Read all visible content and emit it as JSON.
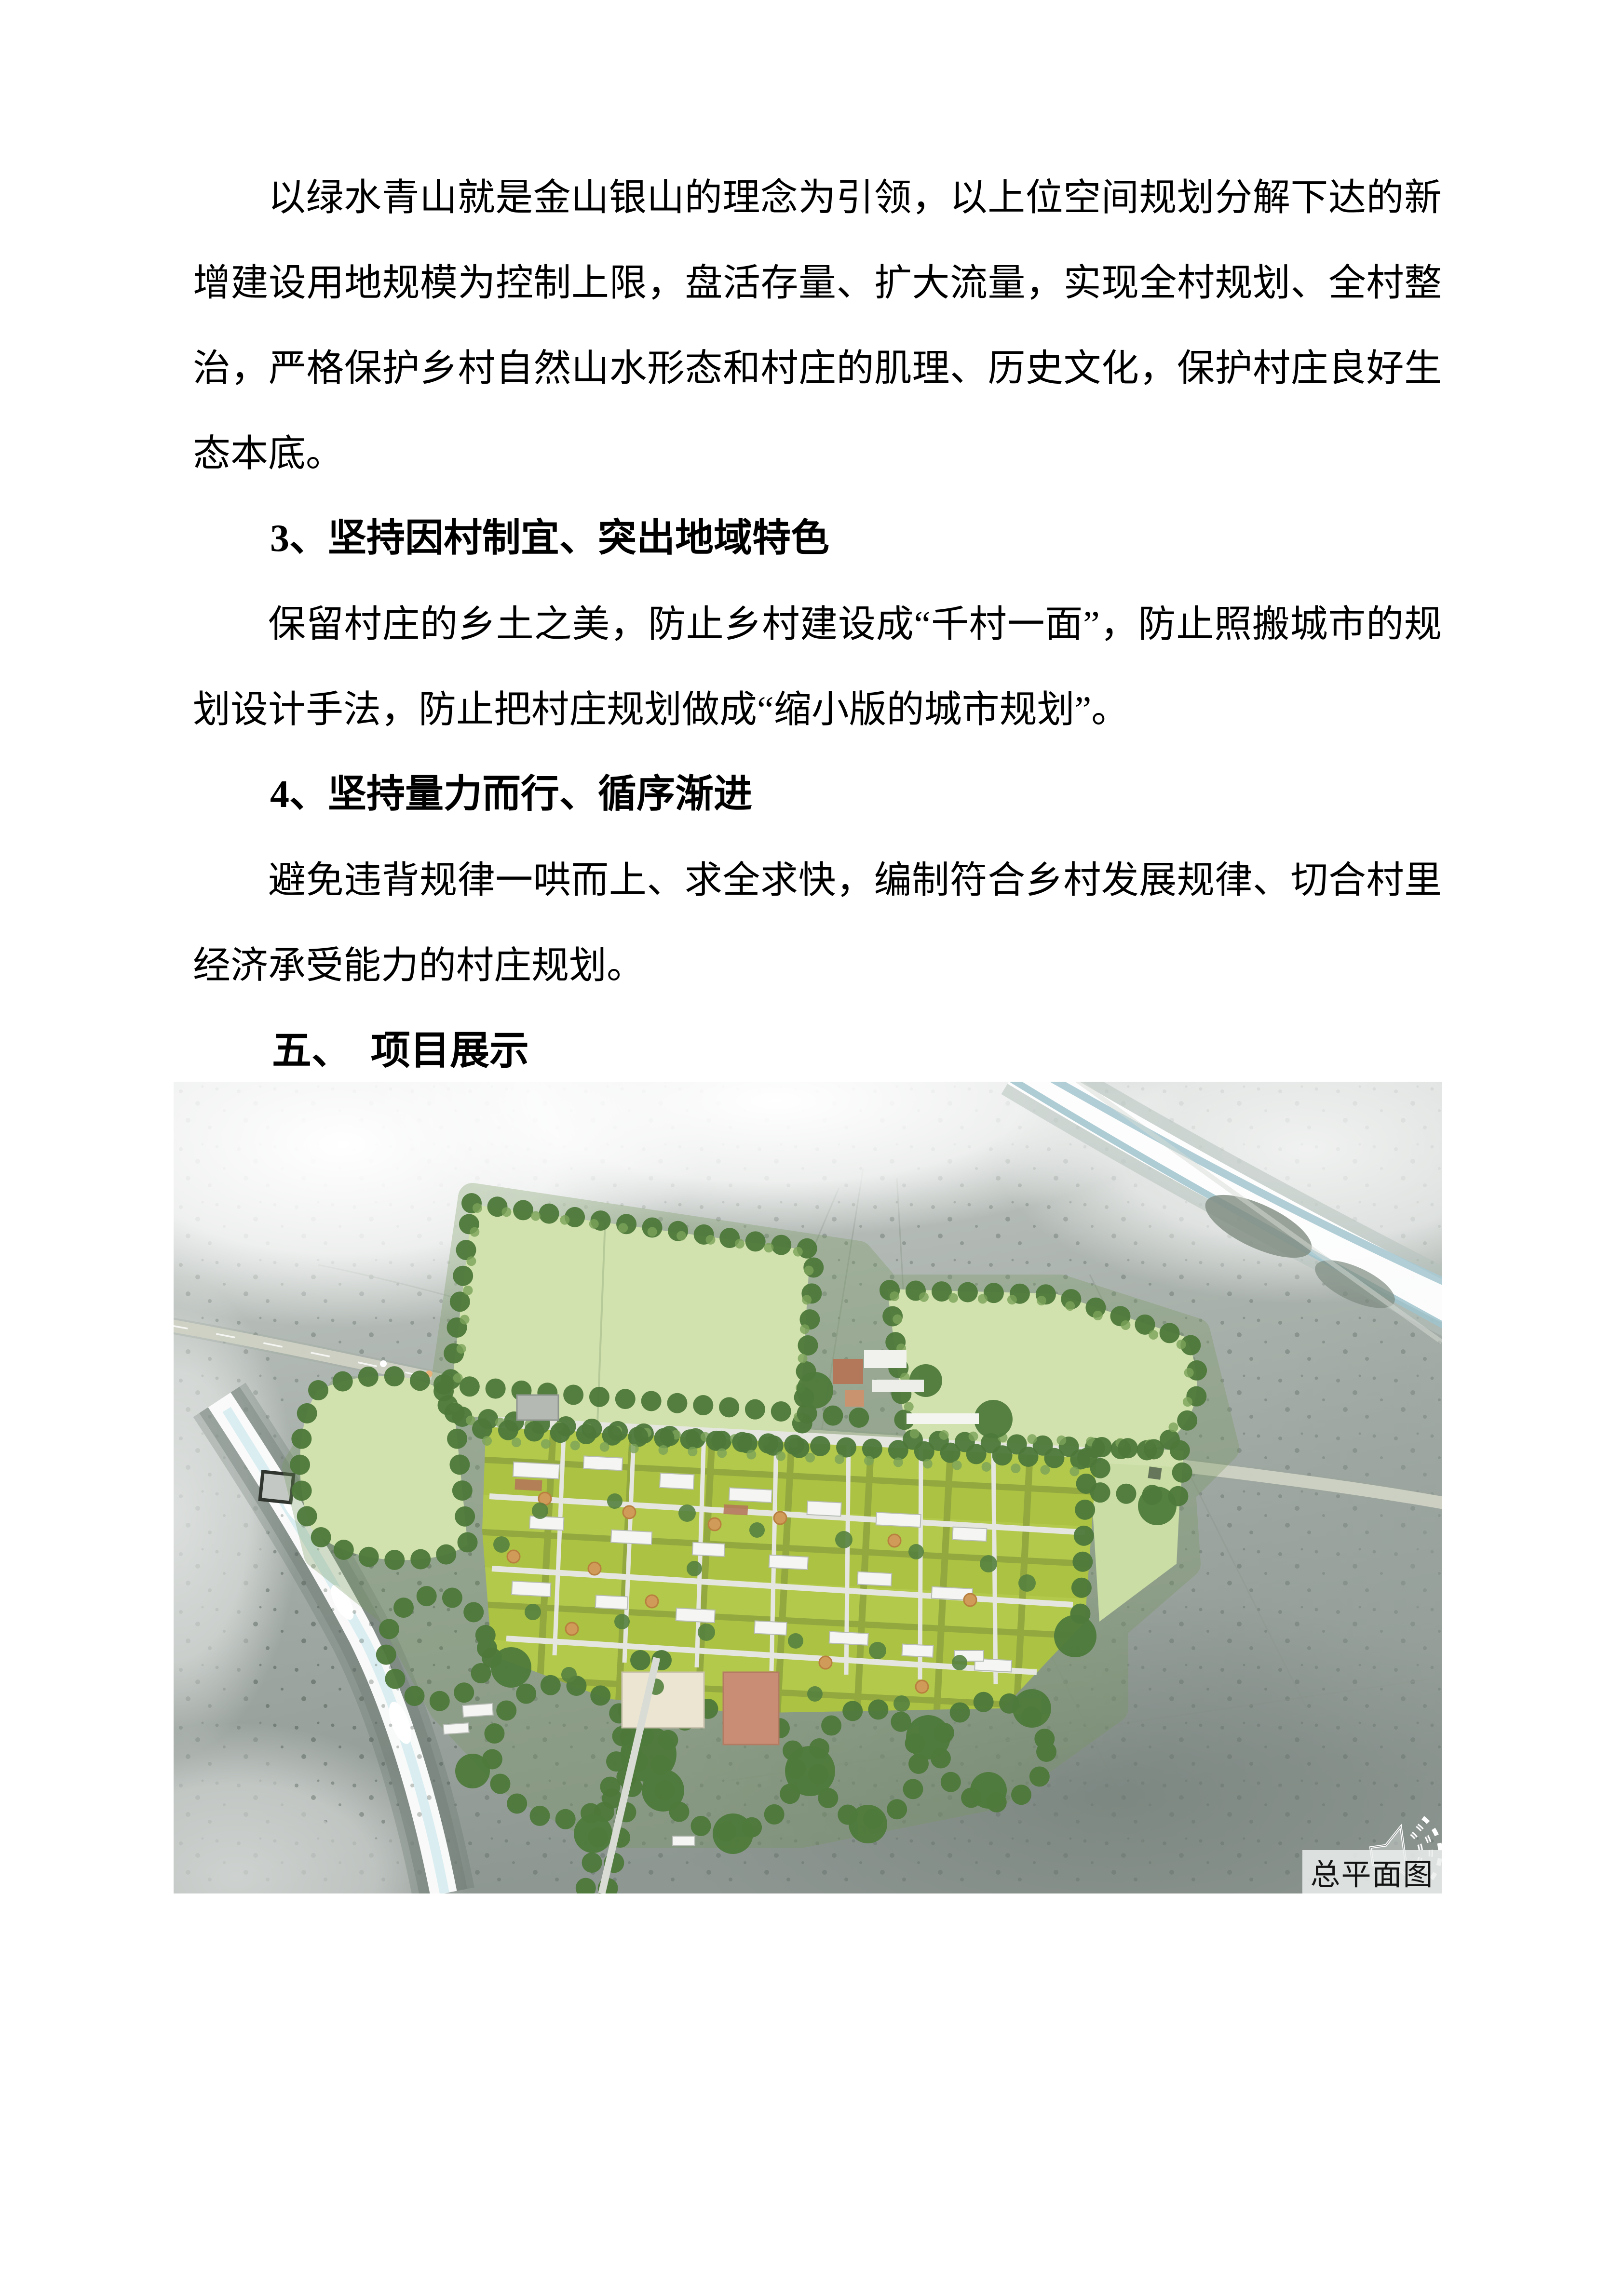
{
  "document": {
    "paragraph_green_water": "以绿水青山就是金山银山的理念为引领，以上位空间规划分解下达的新增建设用地规模为控制上限，盘活存量、扩大流量，实现全村规划、全村整治，严格保护乡村自然山水形态和村庄的肌理、历史文化，保护村庄良好生态本底。",
    "heading_point3": "3、坚持因村制宜、突出地域特色",
    "paragraph_point3": "保留村庄的乡土之美，防止乡村建设成“千村一面”，防止照搬城市的规划设计手法，防止把村庄规划做成“缩小版的城市规划”。",
    "heading_point4": "4、坚持量力而行、循序渐进",
    "paragraph_point4": "避免违背规律一哄而上、求全求快，编制符合乡村发展规律、切合村里经济承受能力的村庄规划。",
    "heading_section5": "五、　项目展示"
  },
  "figure": {
    "caption": "总平面图",
    "icon": "speaker-icon",
    "colors": {
      "terrain_gray": "#a9b1ac",
      "terrain_dark": "#77817b",
      "haze_white": "#ffffff",
      "field_green": "#d2e2ae",
      "plot_green": "#b2c94c",
      "tree_green": "#4d783a",
      "building_white": "#f5f6f3",
      "building_cream": "#ebe5d2",
      "roof_brown": "#b3785a",
      "plaza_salmon": "#c98d75",
      "orange_tree": "#d09a58",
      "road_gray": "#cfd2c4",
      "water_blue": "#a9c9d2",
      "caption_bg": "#e9eceb"
    }
  }
}
